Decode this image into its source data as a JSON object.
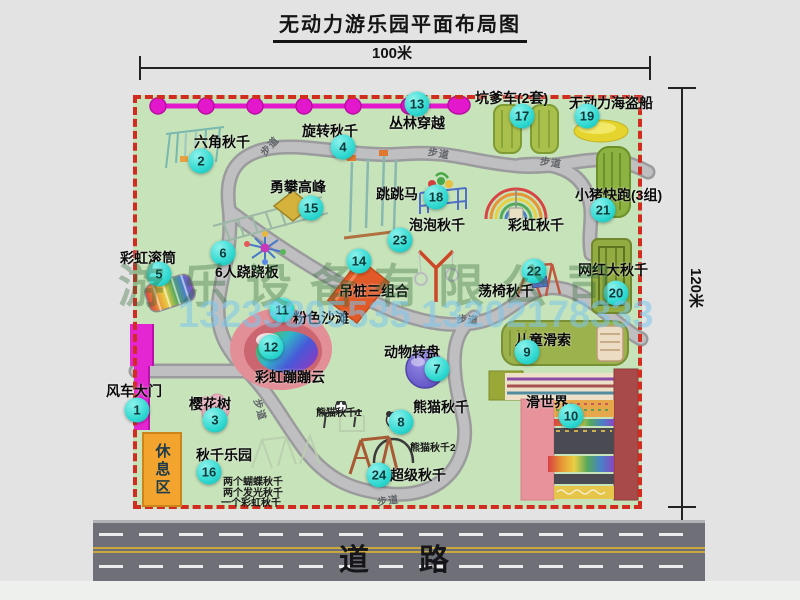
{
  "title": "无动力游乐园平面布局图",
  "dimensions": {
    "top": "100米",
    "right": "120米"
  },
  "road_label": "道　路",
  "rest_area_label": "休息区",
  "walkway_label": "步道",
  "watermark": {
    "company": "游乐设备有限公司",
    "phone": "13233805535 13202178333"
  },
  "attractions": [
    {
      "num": "1",
      "name": "风车大门",
      "badge": [
        137,
        410
      ],
      "label": [
        106,
        381
      ]
    },
    {
      "num": "2",
      "name": "六角秋千",
      "badge": [
        201,
        161
      ],
      "label": [
        194,
        132
      ]
    },
    {
      "num": "3",
      "name": "樱花树",
      "badge": [
        215,
        420
      ],
      "label": [
        189,
        394
      ]
    },
    {
      "num": "4",
      "name": "旋转秋千",
      "badge": [
        343,
        147
      ],
      "label": [
        302,
        121
      ]
    },
    {
      "num": "5",
      "name": "彩虹滚筒",
      "badge": [
        159,
        274
      ],
      "label": [
        120,
        248
      ]
    },
    {
      "num": "6",
      "name": "6人跷跷板",
      "badge": [
        223,
        253
      ],
      "label": [
        215,
        262
      ]
    },
    {
      "num": "7",
      "name": "动物转盘",
      "badge": [
        437,
        369
      ],
      "label": [
        384,
        342
      ]
    },
    {
      "num": "8",
      "name": "熊猫秋千",
      "badge": [
        401,
        422
      ],
      "label": [
        413,
        397
      ],
      "subs": [
        {
          "text": "熊猫秋千1",
          "x": 316,
          "y": 404
        },
        {
          "text": "熊猫秋千2",
          "x": 410,
          "y": 439
        }
      ]
    },
    {
      "num": "9",
      "name": "儿童滑索",
      "badge": [
        527,
        352
      ],
      "label": [
        515,
        330
      ]
    },
    {
      "num": "10",
      "name": "滑世界",
      "badge": [
        571,
        416
      ],
      "label": [
        526,
        392
      ]
    },
    {
      "num": "11",
      "name": "粉色沙滩",
      "badge": [
        282,
        310
      ],
      "label": [
        293,
        308
      ]
    },
    {
      "num": "12",
      "name": "彩虹蹦蹦云",
      "badge": [
        271,
        347
      ],
      "label": [
        255,
        367
      ]
    },
    {
      "num": "13",
      "name": "丛林穿越",
      "badge": [
        417,
        104
      ],
      "label": [
        389,
        113
      ]
    },
    {
      "num": "14",
      "name": "吊桩三组合",
      "badge": [
        359,
        261
      ],
      "label": [
        339,
        281
      ]
    },
    {
      "num": "15",
      "name": "勇攀高峰",
      "badge": [
        311,
        208
      ],
      "label": [
        270,
        177
      ]
    },
    {
      "num": "16",
      "name": "秋千乐园",
      "badge": [
        209,
        472
      ],
      "label": [
        196,
        445
      ],
      "subs": [
        {
          "text": "两个蝴蝶秋千",
          "x": 223,
          "y": 473
        },
        {
          "text": "两个发光秋千",
          "x": 223,
          "y": 484
        },
        {
          "text": "一个彩虹秋千",
          "x": 221,
          "y": 494
        }
      ]
    },
    {
      "num": "17",
      "name": "坑爹车(2套)",
      "badge": [
        522,
        116
      ],
      "label": [
        475,
        88
      ]
    },
    {
      "num": "18",
      "name": "跳跳马",
      "badge": [
        436,
        197
      ],
      "label": [
        376,
        184
      ]
    },
    {
      "num": "19",
      "name": "无动力海盗船",
      "badge": [
        587,
        116
      ],
      "label": [
        569,
        93
      ]
    },
    {
      "num": "20",
      "name": "网红大秋千",
      "badge": [
        616,
        293
      ],
      "label": [
        578,
        260
      ]
    },
    {
      "num": "21",
      "name": "小猪快跑(3组)",
      "badge": [
        603,
        210
      ],
      "label": [
        575,
        185
      ]
    },
    {
      "num": "22",
      "name": "荡椅秋千",
      "badge": [
        534,
        271
      ],
      "label": [
        478,
        281
      ]
    },
    {
      "num": "23",
      "name": "泡泡秋千",
      "badge": [
        400,
        240
      ],
      "label": [
        409,
        215
      ]
    },
    {
      "num": "24",
      "name": "超级秋千",
      "badge": [
        379,
        475
      ],
      "label": [
        390,
        465
      ]
    }
  ],
  "extra_labels": [
    {
      "text": "彩虹秋千",
      "x": 508,
      "y": 215
    }
  ],
  "walkway_positions": [
    {
      "x": 258,
      "y": 138,
      "r": -48
    },
    {
      "x": 428,
      "y": 145,
      "r": 10
    },
    {
      "x": 540,
      "y": 154,
      "r": 8
    },
    {
      "x": 250,
      "y": 402,
      "r": 74
    },
    {
      "x": 457,
      "y": 311,
      "r": 4
    },
    {
      "x": 377,
      "y": 492,
      "r": -8
    }
  ],
  "colors": {
    "map_bg": "#c7e3ba",
    "border_red": "#d22c20",
    "badge": "#2dd8d0",
    "gate_magenta": "#e426d2",
    "zipline": "#e318cc",
    "road": "#6f6f77",
    "walkway": "#bfbfc1",
    "rest_area": "#f2a42e"
  }
}
